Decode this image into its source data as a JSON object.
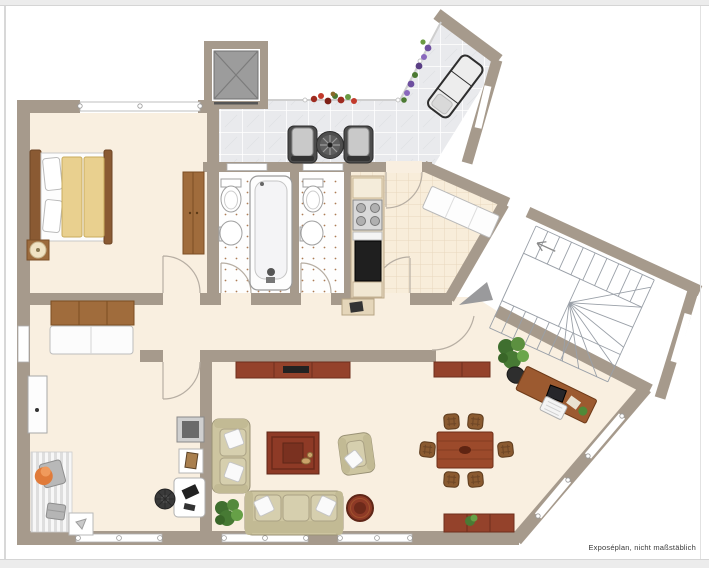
{
  "caption": "Exposéplan, nicht maßstäblich",
  "palette": {
    "wall": "#a69a8c",
    "floor": "#f9efe0",
    "terrace-tile": "#e9eaed",
    "wood-dark": "#94422b",
    "wood-mid": "#a06c3c",
    "sofa-beige": "#cdc5a0",
    "rug-red": "#8e3a26",
    "chrome-edge": "#ececec"
  }
}
